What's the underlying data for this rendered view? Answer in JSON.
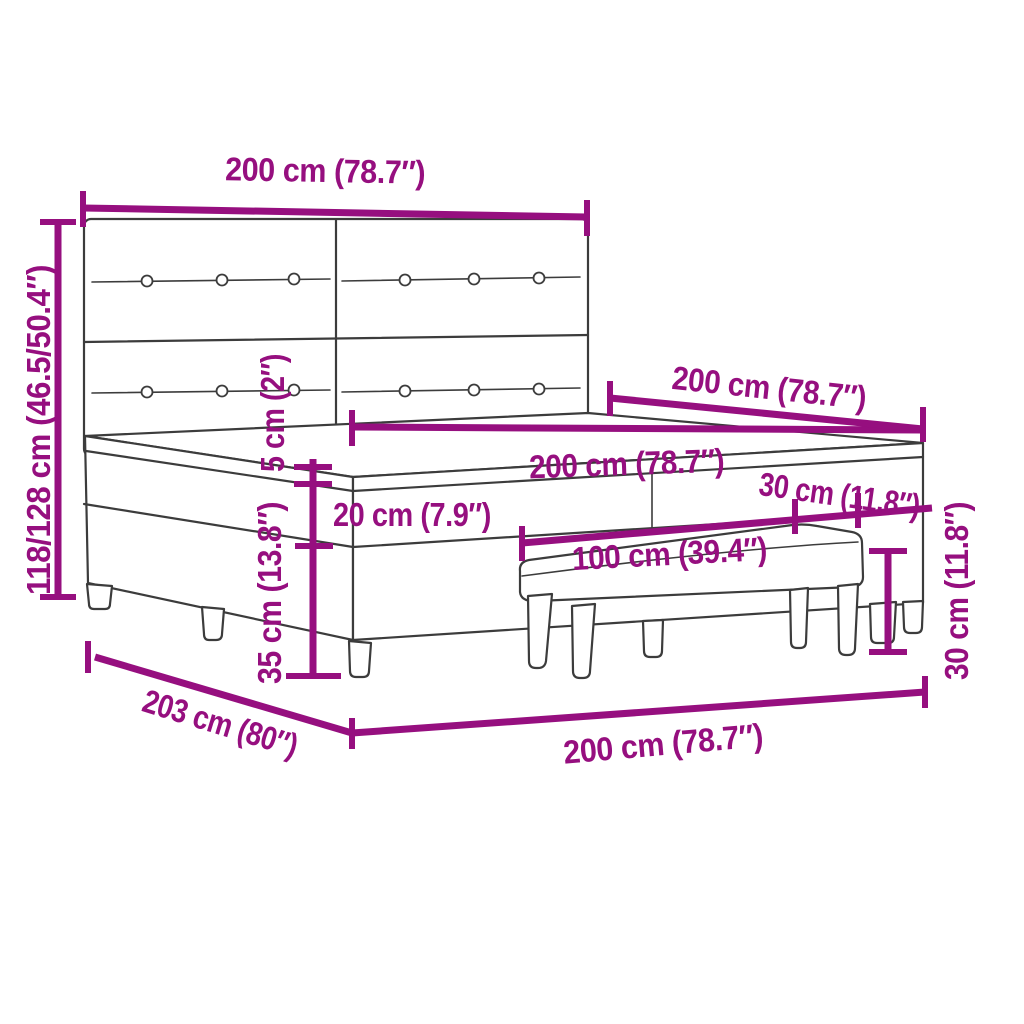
{
  "diagram": {
    "type": "product-dimension-diagram",
    "subject": "box spring bed with tufted headboard and bench",
    "colors": {
      "dimension": "#960F7F",
      "line_art": "#3C3C3C",
      "background": "#FFFFFF"
    },
    "labels": {
      "headboard_width": "200 cm (78.7″)",
      "overall_height": "118/128 cm (46.5/50.4″)",
      "topper_thickness": "5 cm (2″)",
      "mattress_thickness": "20 cm (7.9″)",
      "base_height": "35 cm (13.8″)",
      "bed_length": "200 cm (78.7″)",
      "mattress_width": "200 cm (78.7″)",
      "bench_seat_depth": "30 cm (11.8″)",
      "bench_length": "100 cm (39.4″)",
      "bench_height": "30 cm (11.8″)",
      "overall_length": "203 cm (80″)",
      "overall_width": "200 cm (78.7″)"
    }
  }
}
